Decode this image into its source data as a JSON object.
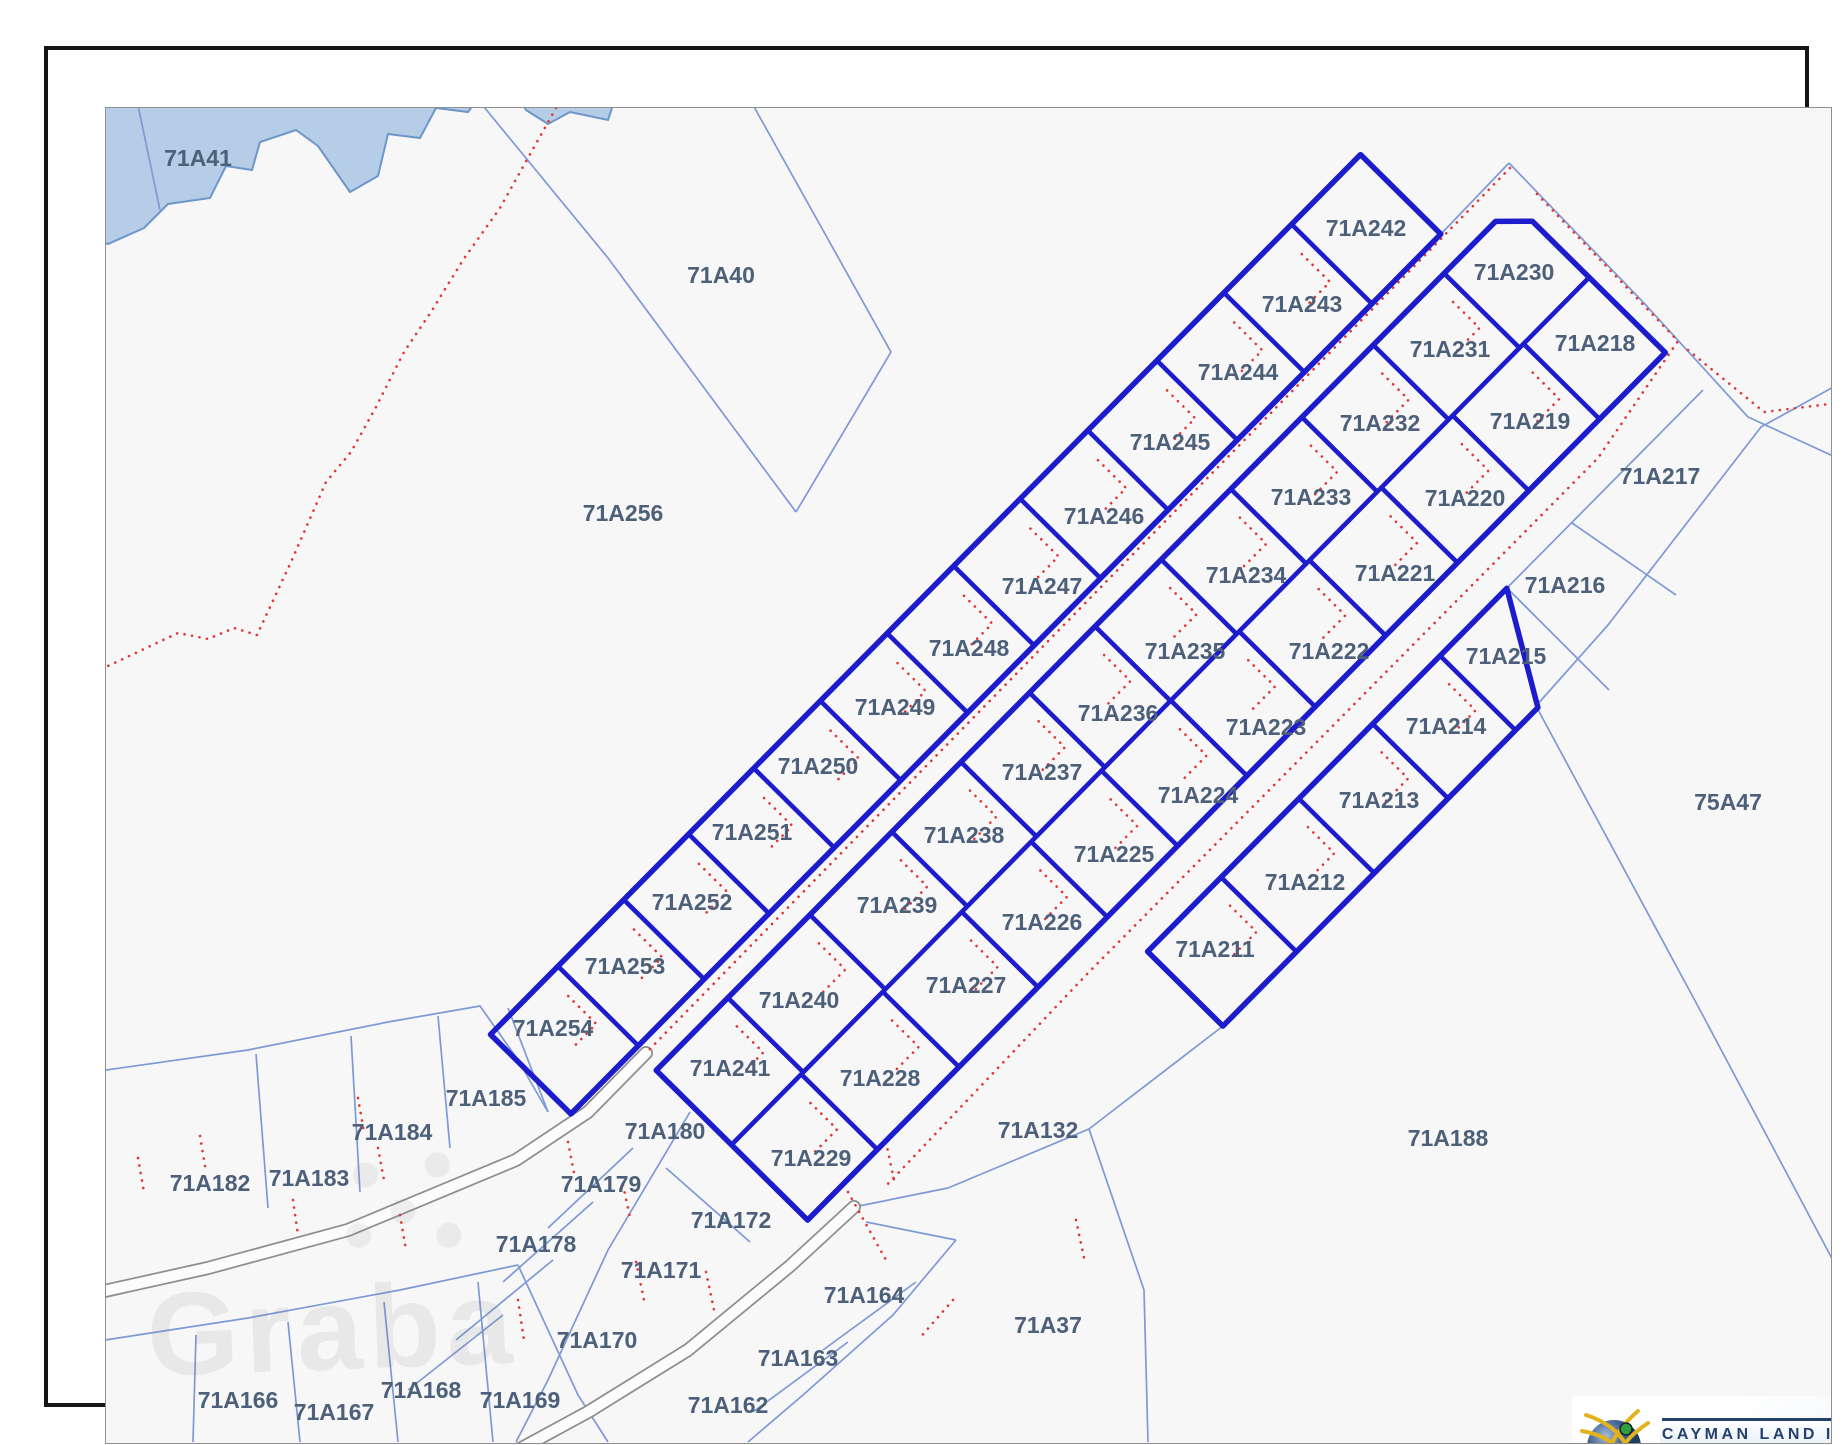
{
  "map": {
    "colors": {
      "thick_parcel": "#1c1ccd",
      "thin_parcel": "#7d99d6",
      "red_dotted": "#e23636",
      "water_fill": "#b5cde6",
      "water_edge": "#6e96c8",
      "label_text": "#4d6079",
      "road_casing": "#8e8e8e",
      "road_fill": "#fcfcfc",
      "map_bg": "#f7f7f8"
    },
    "basis": {
      "u": [
        -0.703,
        0.711
      ],
      "v": [
        0.711,
        0.703
      ]
    },
    "labels": [
      {
        "t": "71A41",
        "x": 150,
        "y": 108
      },
      {
        "t": "71A40",
        "x": 673,
        "y": 225
      },
      {
        "t": "71A256",
        "x": 575,
        "y": 463
      },
      {
        "t": "71A242",
        "x": 1318,
        "y": 178
      },
      {
        "t": "71A230",
        "x": 1466,
        "y": 222
      },
      {
        "t": "71A243",
        "x": 1254,
        "y": 254
      },
      {
        "t": "71A231",
        "x": 1402,
        "y": 299
      },
      {
        "t": "71A218",
        "x": 1547,
        "y": 293
      },
      {
        "t": "71A244",
        "x": 1190,
        "y": 322
      },
      {
        "t": "71A232",
        "x": 1332,
        "y": 373
      },
      {
        "t": "71A219",
        "x": 1482,
        "y": 371
      },
      {
        "t": "71A245",
        "x": 1122,
        "y": 392
      },
      {
        "t": "71A233",
        "x": 1263,
        "y": 447
      },
      {
        "t": "71A220",
        "x": 1417,
        "y": 448
      },
      {
        "t": "71A217",
        "x": 1612,
        "y": 426
      },
      {
        "t": "71A246",
        "x": 1056,
        "y": 466
      },
      {
        "t": "71A234",
        "x": 1198,
        "y": 525
      },
      {
        "t": "71A221",
        "x": 1347,
        "y": 523
      },
      {
        "t": "71A216",
        "x": 1517,
        "y": 535
      },
      {
        "t": "71A247",
        "x": 994,
        "y": 536
      },
      {
        "t": "71A235",
        "x": 1137,
        "y": 601
      },
      {
        "t": "71A222",
        "x": 1281,
        "y": 601
      },
      {
        "t": "71A215",
        "x": 1458,
        "y": 606
      },
      {
        "t": "71A248",
        "x": 921,
        "y": 598
      },
      {
        "t": "71A236",
        "x": 1070,
        "y": 663
      },
      {
        "t": "71A223",
        "x": 1218,
        "y": 677
      },
      {
        "t": "71A214",
        "x": 1398,
        "y": 676
      },
      {
        "t": "71A249",
        "x": 847,
        "y": 657
      },
      {
        "t": "71A237",
        "x": 994,
        "y": 722
      },
      {
        "t": "71A224",
        "x": 1150,
        "y": 745
      },
      {
        "t": "71A213",
        "x": 1331,
        "y": 750
      },
      {
        "t": "71A250",
        "x": 770,
        "y": 716
      },
      {
        "t": "71A238",
        "x": 916,
        "y": 785
      },
      {
        "t": "71A225",
        "x": 1066,
        "y": 804
      },
      {
        "t": "71A212",
        "x": 1257,
        "y": 832
      },
      {
        "t": "71A251",
        "x": 704,
        "y": 782
      },
      {
        "t": "71A239",
        "x": 849,
        "y": 855
      },
      {
        "t": "71A226",
        "x": 994,
        "y": 872
      },
      {
        "t": "71A211",
        "x": 1167,
        "y": 899
      },
      {
        "t": "71A252",
        "x": 644,
        "y": 852
      },
      {
        "t": "71A227",
        "x": 918,
        "y": 935
      },
      {
        "t": "71A253",
        "x": 577,
        "y": 916
      },
      {
        "t": "71A240",
        "x": 751,
        "y": 950
      },
      {
        "t": "71A228",
        "x": 832,
        "y": 1028
      },
      {
        "t": "71A254",
        "x": 505,
        "y": 978
      },
      {
        "t": "71A241",
        "x": 682,
        "y": 1018
      },
      {
        "t": "71A185",
        "x": 438,
        "y": 1048
      },
      {
        "t": "71A180",
        "x": 617,
        "y": 1081
      },
      {
        "t": "71A229",
        "x": 763,
        "y": 1108
      },
      {
        "t": "71A184",
        "x": 344,
        "y": 1082
      },
      {
        "t": "71A183",
        "x": 261,
        "y": 1128
      },
      {
        "t": "71A182",
        "x": 162,
        "y": 1133
      },
      {
        "t": "71A179",
        "x": 553,
        "y": 1134
      },
      {
        "t": "71A178",
        "x": 488,
        "y": 1194
      },
      {
        "t": "71A172",
        "x": 683,
        "y": 1170
      },
      {
        "t": "71A171",
        "x": 613,
        "y": 1220
      },
      {
        "t": "71A170",
        "x": 549,
        "y": 1290
      },
      {
        "t": "71A164",
        "x": 816,
        "y": 1245
      },
      {
        "t": "71A163",
        "x": 750,
        "y": 1308
      },
      {
        "t": "71A162",
        "x": 680,
        "y": 1355
      },
      {
        "t": "71A166",
        "x": 190,
        "y": 1350
      },
      {
        "t": "71A167",
        "x": 286,
        "y": 1362
      },
      {
        "t": "71A168",
        "x": 373,
        "y": 1340
      },
      {
        "t": "71A169",
        "x": 472,
        "y": 1350
      },
      {
        "t": "71A132",
        "x": 990,
        "y": 1080
      },
      {
        "t": "71A188",
        "x": 1400,
        "y": 1088
      },
      {
        "t": "71A37",
        "x": 1000,
        "y": 1275
      },
      {
        "t": "75A47",
        "x": 1680,
        "y": 752
      }
    ],
    "strips": [
      {
        "outline_cq": [
          [
            1007,
            -848.5
          ],
          [
            1120,
            -848.5
          ],
          [
            1120,
            389
          ],
          [
            1007,
            389
          ]
        ],
        "center_lines_cq": [],
        "cols": [
          {
            "c0": 1007,
            "c1": 1120,
            "cells_q": [
              -800,
              -701,
              -607.7,
              -510.1,
              -411.1,
              -317.7,
              -222.3,
              -128.3,
              -32.2,
              61.1,
              153.1,
              245.7,
              340.4
            ]
          }
        ]
      },
      {
        "outline_cq": [
          [
            1150,
            -896
          ],
          [
            1176,
            -922
          ],
          [
            1363,
            -922
          ],
          [
            1363,
            298
          ],
          [
            1150,
            298
          ]
        ],
        "center_lines_cq": [
          [
            [
              1256,
              -922
            ],
            [
              1256,
              298
            ]
          ]
        ],
        "cols": [
          {
            "c0": 1150,
            "c1": 1256,
            "cells_q": [
              -872.8,
              -773,
              -671.2,
              -570.1,
              -468.9,
              -372,
              -280.8,
              -185.5,
              -85.9,
              11.1,
              147.5,
              244.4
            ]
          },
          {
            "c0": 1256,
            "c1": 1363,
            "cells_q": [
              -879.2,
              -778,
              -677.7,
              -575.1,
              -473.2,
              -375,
              -278.8,
              -177.8,
              -78.8,
              19.4,
              146,
              251.4
            ]
          }
        ]
      },
      {
        "outline_cq": [
          [
            1416,
            -643
          ],
          [
            1522,
            -580
          ],
          [
            1522,
            -132
          ],
          [
            1416,
            -132
          ]
        ],
        "center_lines_cq": [],
        "cols": [
          {
            "c0": 1416,
            "c1": 1522,
            "cells_q": [
              -594.1,
              -502.2,
              -402.4,
              -292.1,
              -181.2
            ]
          }
        ]
      }
    ],
    "water": {
      "polygons": [
        [
          [
            44,
            46
          ],
          [
            432,
            46
          ],
          [
            420,
            62
          ],
          [
            388,
            58
          ],
          [
            372,
            88
          ],
          [
            340,
            84
          ],
          [
            330,
            126
          ],
          [
            302,
            142
          ],
          [
            270,
            96
          ],
          [
            248,
            80
          ],
          [
            212,
            92
          ],
          [
            204,
            120
          ],
          [
            178,
            116
          ],
          [
            162,
            148
          ],
          [
            120,
            154
          ],
          [
            96,
            178
          ],
          [
            60,
            194
          ],
          [
            44,
            188
          ]
        ],
        [
          [
            470,
            46
          ],
          [
            568,
            46
          ],
          [
            560,
            70
          ],
          [
            522,
            62
          ],
          [
            500,
            74
          ],
          [
            478,
            60
          ]
        ]
      ]
    },
    "thin_lines": [
      [
        [
          88,
          46
        ],
        [
          112,
          160
        ]
      ],
      [
        [
          427,
          46
        ],
        [
          560,
          208
        ],
        [
          748,
          462
        ]
      ],
      [
        [
          748,
          462
        ],
        [
          843,
          302
        ],
        [
          700,
          46
        ]
      ],
      [
        [
          1461,
          113
        ],
        [
          1393,
          184
        ]
      ],
      [
        [
          1461,
          113
        ],
        [
          1595,
          252
        ],
        [
          1700,
          367
        ],
        [
          1798,
          412
        ]
      ],
      [
        [
          1798,
          330
        ],
        [
          1713,
          377
        ],
        [
          1560,
          575
        ],
        [
          1488,
          656
        ],
        [
          1652,
          960
        ],
        [
          1798,
          1235
        ]
      ],
      [
        [
          1655,
          340
        ],
        [
          1459,
          538
        ]
      ],
      [
        [
          1524,
          473
        ],
        [
          1628,
          545
        ]
      ],
      [
        [
          1459,
          538
        ],
        [
          1561,
          640
        ]
      ],
      [
        [
          1175,
          976
        ],
        [
          1041,
          1079
        ]
      ],
      [
        [
          1041,
          1079
        ],
        [
          1096,
          1240
        ],
        [
          1100,
          1392
        ]
      ],
      [
        [
          1041,
          1079
        ],
        [
          900,
          1138
        ],
        [
          806,
          1157
        ]
      ],
      [
        [
          44,
          1022
        ],
        [
          200,
          1000
        ],
        [
          340,
          972
        ],
        [
          432,
          956
        ],
        [
          470,
          1010
        ],
        [
          500,
          1062
        ]
      ],
      [
        [
          208,
          1004
        ],
        [
          220,
          1158
        ]
      ],
      [
        [
          303,
          986
        ],
        [
          312,
          1142
        ]
      ],
      [
        [
          390,
          966
        ],
        [
          402,
          1098
        ]
      ],
      [
        [
          460,
          958
        ],
        [
          500,
          1062
        ]
      ],
      [
        [
          585,
          1098
        ],
        [
          500,
          1178
        ]
      ],
      [
        [
          545,
          1152
        ],
        [
          455,
          1232
        ]
      ],
      [
        [
          505,
          1210
        ],
        [
          408,
          1290
        ]
      ],
      [
        [
          455,
          1265
        ],
        [
          360,
          1340
        ]
      ],
      [
        [
          642,
          1062
        ],
        [
          560,
          1200
        ],
        [
          500,
          1330
        ],
        [
          468,
          1392
        ]
      ],
      [
        [
          44,
          1292
        ],
        [
          200,
          1268
        ],
        [
          352,
          1240
        ],
        [
          470,
          1215
        ]
      ],
      [
        [
          240,
          1272
        ],
        [
          252,
          1392
        ]
      ],
      [
        [
          336,
          1252
        ],
        [
          350,
          1392
        ]
      ],
      [
        [
          430,
          1232
        ],
        [
          445,
          1392
        ]
      ],
      [
        [
          148,
          1285
        ],
        [
          145,
          1392
        ]
      ],
      [
        [
          470,
          1215
        ],
        [
          530,
          1345
        ],
        [
          560,
          1392
        ]
      ],
      [
        [
          618,
          1118
        ],
        [
          702,
          1192
        ]
      ],
      [
        [
          908,
          1190
        ],
        [
          845,
          1265
        ],
        [
          755,
          1345
        ],
        [
          700,
          1392
        ]
      ],
      [
        [
          868,
          1232
        ],
        [
          775,
          1300
        ]
      ],
      [
        [
          800,
          1292
        ],
        [
          705,
          1362
        ]
      ],
      [
        [
          818,
          1172
        ],
        [
          908,
          1190
        ]
      ]
    ],
    "paved_roads": [
      [
        [
          598,
          1003
        ],
        [
          540,
          1062
        ],
        [
          468,
          1110
        ],
        [
          300,
          1180
        ],
        [
          160,
          1218
        ],
        [
          52,
          1242
        ]
      ],
      [
        [
          806,
          1157
        ],
        [
          742,
          1216
        ],
        [
          640,
          1300
        ],
        [
          540,
          1362
        ],
        [
          470,
          1400
        ]
      ]
    ],
    "red_routes": [
      [
        [
          508,
          58
        ],
        [
          452,
          158
        ],
        [
          415,
          210
        ],
        [
          383,
          262
        ],
        [
          356,
          302
        ],
        [
          328,
          357
        ],
        [
          303,
          402
        ],
        [
          278,
          432
        ],
        [
          243,
          512
        ],
        [
          209,
          585
        ],
        [
          186,
          578
        ],
        [
          160,
          589
        ],
        [
          130,
          583
        ],
        [
          96,
          599
        ],
        [
          60,
          616
        ]
      ],
      [
        [
          1462,
          118
        ],
        [
          598,
          1003
        ]
      ],
      [
        [
          1489,
          144
        ],
        [
          1630,
          291
        ],
        [
          1550,
          408
        ],
        [
          1040,
          923
        ],
        [
          836,
          1138
        ]
      ],
      [
        [
          1640,
          300
        ],
        [
          1716,
          362
        ],
        [
          1798,
          352
        ]
      ],
      [
        [
          823,
          954
        ],
        [
          682,
          1096
        ]
      ],
      [
        [
          800,
          1142
        ],
        [
          838,
          1210
        ]
      ]
    ],
    "red_stubs": [
      [
        [
          90,
          1108
        ],
        [
          96,
          1142
        ]
      ],
      [
        [
          152,
          1086
        ],
        [
          158,
          1122
        ]
      ],
      [
        [
          310,
          1048
        ],
        [
          316,
          1082
        ]
      ],
      [
        [
          330,
          1098
        ],
        [
          336,
          1130
        ]
      ],
      [
        [
          520,
          1092
        ],
        [
          527,
          1128
        ]
      ],
      [
        [
          575,
          1135
        ],
        [
          583,
          1172
        ]
      ],
      [
        [
          588,
          1212
        ],
        [
          596,
          1250
        ]
      ],
      [
        [
          658,
          1222
        ],
        [
          666,
          1260
        ]
      ],
      [
        [
          838,
          1092
        ],
        [
          846,
          1130
        ]
      ],
      [
        [
          1028,
          1170
        ],
        [
          1036,
          1208
        ]
      ],
      [
        [
          470,
          1250
        ],
        [
          476,
          1290
        ]
      ],
      [
        [
          245,
          1150
        ],
        [
          250,
          1185
        ]
      ],
      [
        [
          352,
          1165
        ],
        [
          358,
          1200
        ]
      ],
      [
        [
          905,
          1250
        ],
        [
          870,
          1290
        ]
      ]
    ]
  },
  "watermark": {
    "text": "Graba"
  },
  "footer": {
    "timestamp": "3/26/26 12:26 PM"
  },
  "logo": {
    "title": "CAYMAN LAND INFO",
    "url": "www.caymanlandinfo.ky",
    "globe_colors": {
      "sphere": "#41628f",
      "arcs": "#e3b31c",
      "dot_green": "#2f9e3c",
      "dot_blue": "#3b6fd4",
      "dot_red": "#cc2f2f"
    }
  }
}
